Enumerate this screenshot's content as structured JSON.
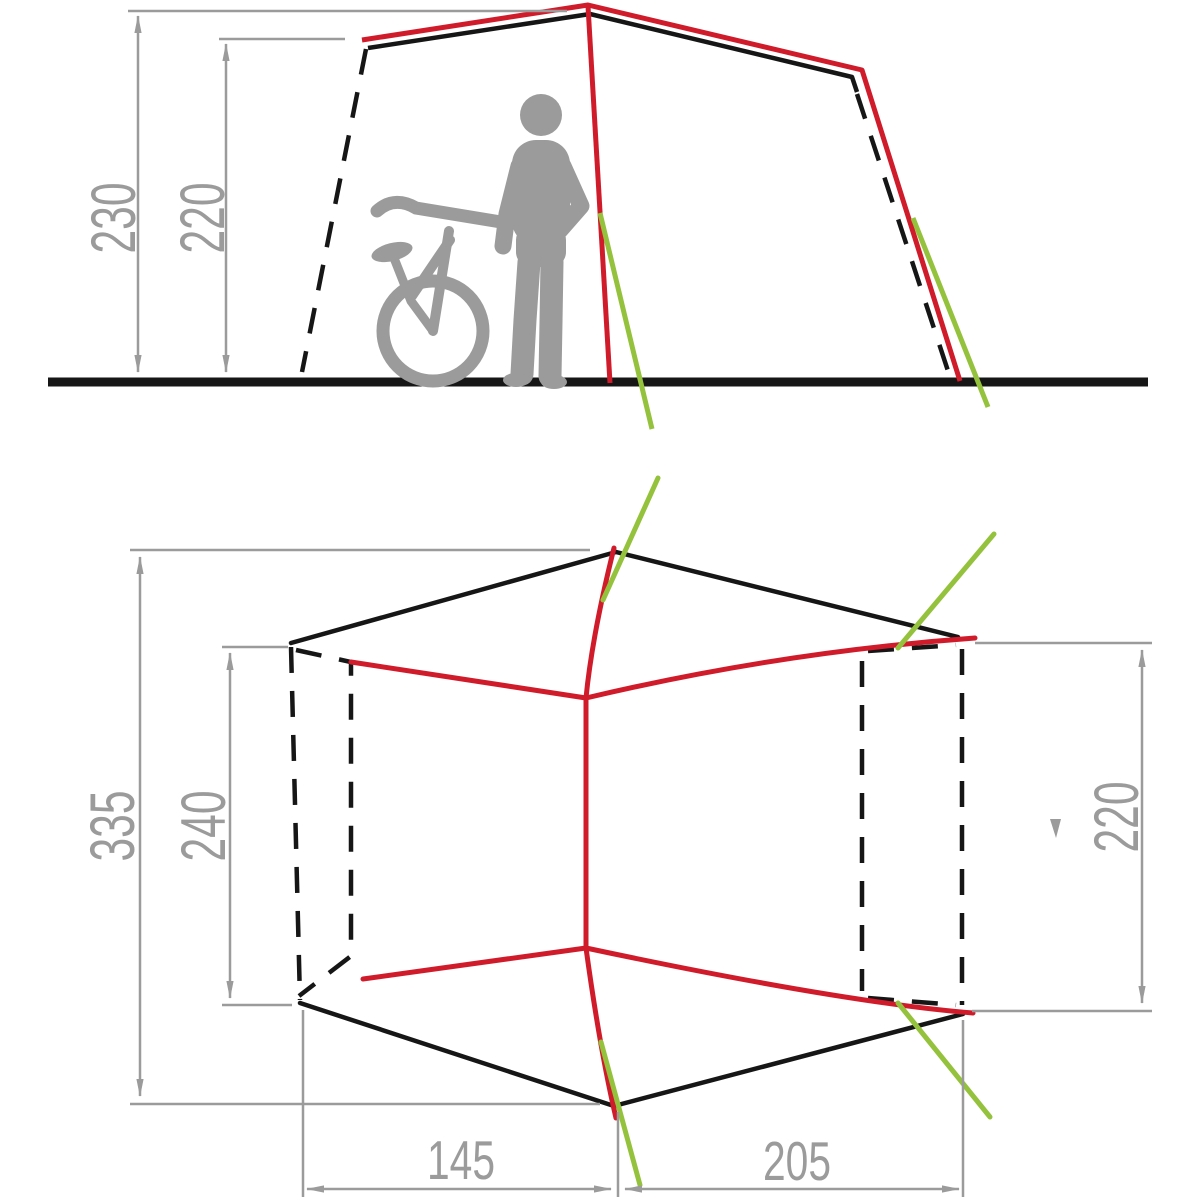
{
  "diagram": {
    "type": "tent-dimension-drawing",
    "views": [
      "side-elevation",
      "floor-plan"
    ]
  },
  "labels": {
    "side_peak_height": "230",
    "side_entry_height": "220",
    "plan_total_length": "335",
    "plan_inner_length": "240",
    "plan_side_door_width": "220",
    "plan_front_segment": "145",
    "plan_rear_segment": "205"
  },
  "dimensions_data": {
    "side_view": [
      {
        "name": "peak-height",
        "value": 230
      },
      {
        "name": "entry-height",
        "value": 220
      }
    ],
    "plan_view": [
      {
        "name": "total-length",
        "value": 335
      },
      {
        "name": "inner-cabin-length",
        "value": 240
      },
      {
        "name": "side-door-width",
        "value": 220
      },
      {
        "name": "front-floor-segment",
        "value": 145
      },
      {
        "name": "rear-floor-segment",
        "value": 205
      }
    ]
  },
  "colors": {
    "outline_black": "#161616",
    "pole_red": "#d01b2a",
    "guy_line_green": "#94c23c",
    "dimension_gray": "#9b9b9b",
    "silhouette_gray": "#9b9b9b",
    "background": "#ffffff"
  }
}
